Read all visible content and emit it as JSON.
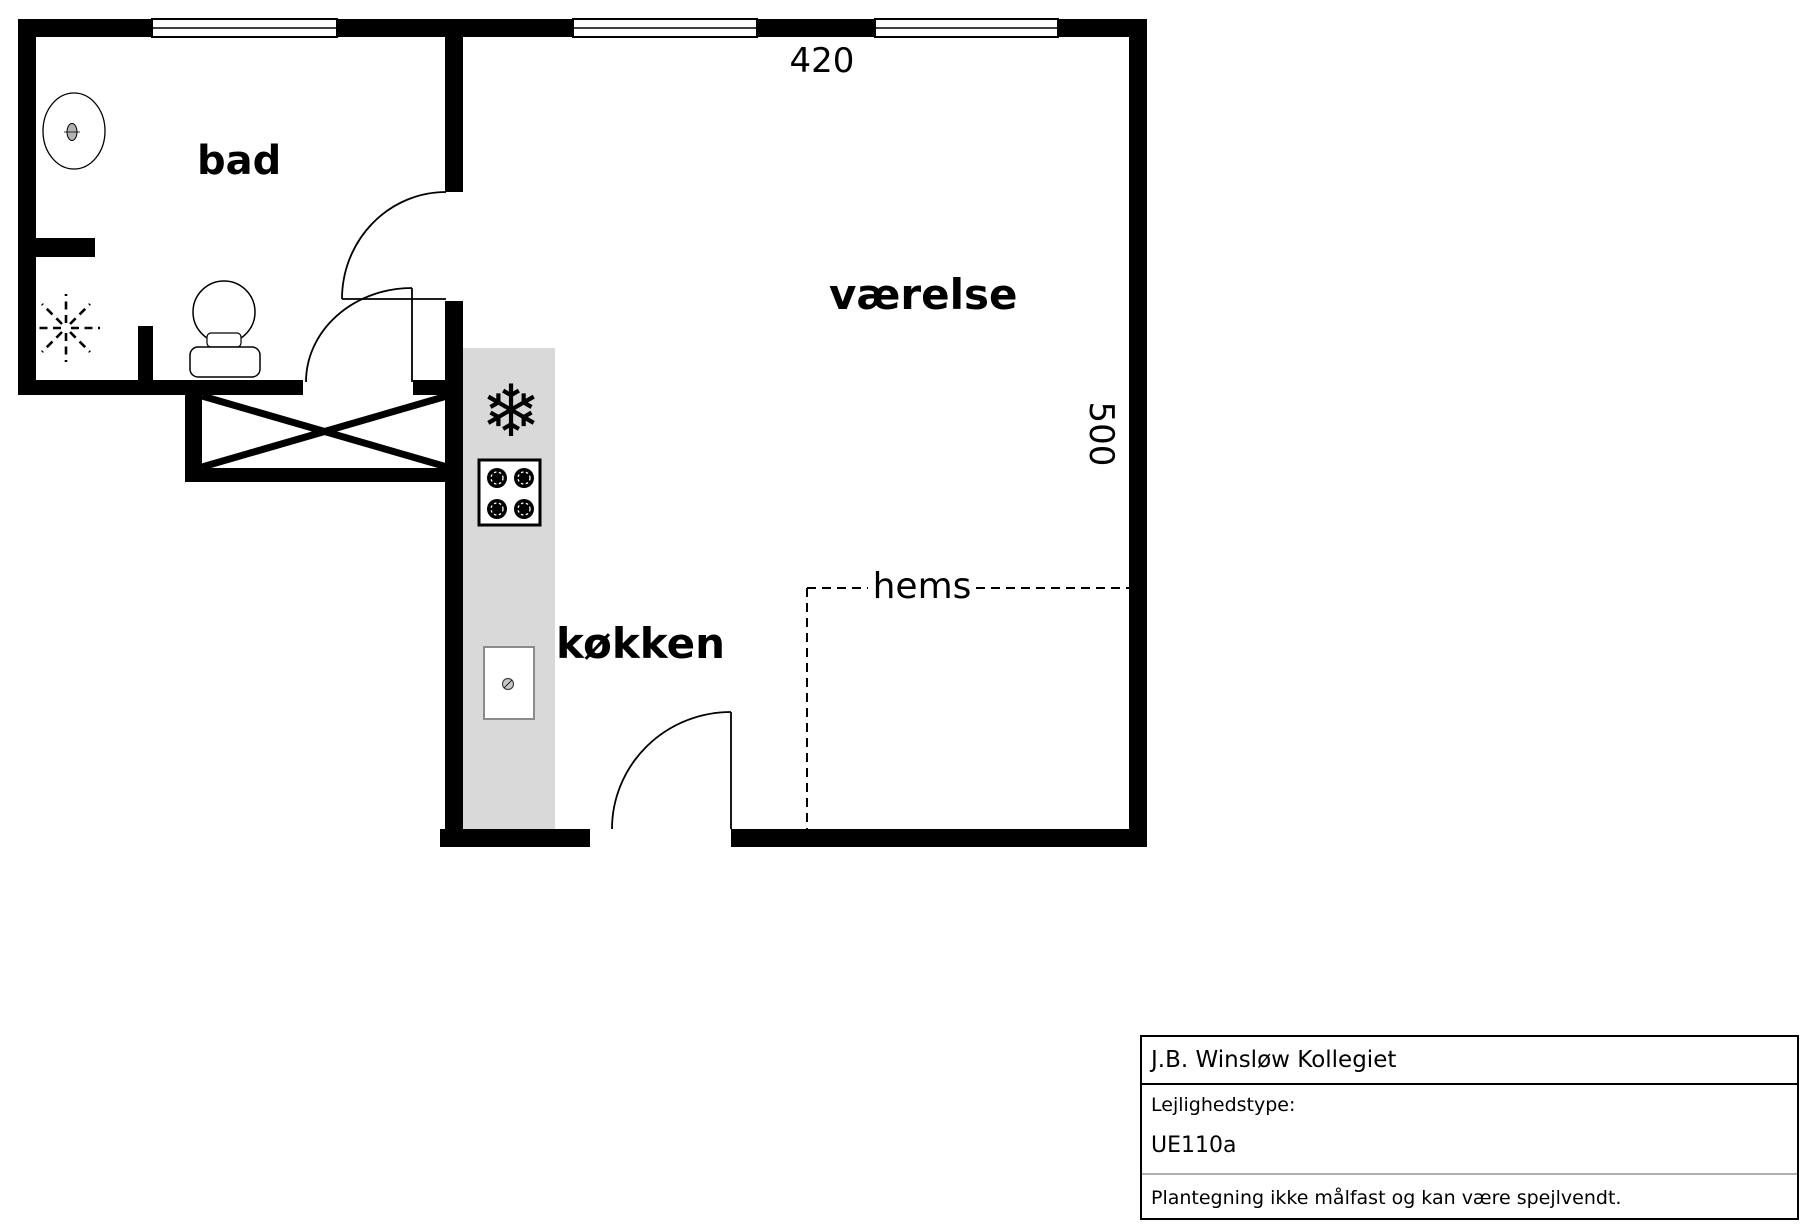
{
  "plan": {
    "labels": {
      "bathroom": "bad",
      "room": "værelse",
      "kitchen": "køkken",
      "loft": "hems"
    },
    "dimensions": {
      "width_top": "420",
      "depth_right": "500"
    }
  },
  "fixtures": {
    "freezer_glyph": "❄"
  },
  "title_block": {
    "project": "J.B. Winsløw Kollegiet",
    "type_label": "Lejlighedstype:",
    "type_value": "UE110a",
    "disclaimer": "Plantegning ikke målfast og kan være spejlvendt."
  },
  "colors": {
    "wall": "#000000",
    "counter": "#d9d9d9",
    "divider_light": "#b0b0b0"
  }
}
